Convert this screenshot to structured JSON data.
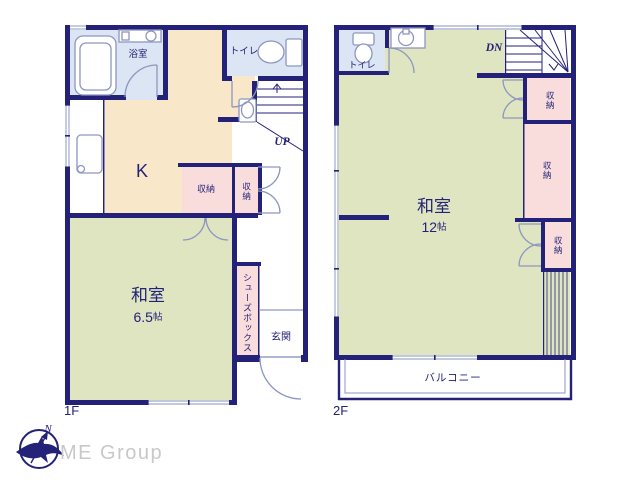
{
  "plan": {
    "floor1": {
      "label": "1F",
      "bathroom": "浴室",
      "toilet": "トイレ",
      "kitchen": "K",
      "storage_a": "収納",
      "storage_b": "収納",
      "tatami_room": "和室",
      "tatami_size_value": "6.5",
      "tatami_size_unit": "帖",
      "shoes_box": "シューズボックス",
      "entrance": "玄関",
      "stairs_up": "UP"
    },
    "floor2": {
      "label": "2F",
      "toilet": "トイレ",
      "stairs_down": "DN",
      "storage_a": "収納",
      "storage_b": "収納",
      "storage_c": "収納",
      "tatami_room": "和室",
      "tatami_size_value": "12",
      "tatami_size_unit": "帖",
      "balcony": "バルコニー"
    },
    "compass_north": "N",
    "company": "ME Group",
    "colors": {
      "wall_navy": "#232278",
      "tatami_green": "#dfe5c1",
      "kitchen_cream": "#f9e7c9",
      "wet_area_blue": "#dbe5f3",
      "closet_pink": "#f9dddd",
      "window_gray": "#aeb6d4",
      "fixture_line": "#8d96c0",
      "logo_gray": "#c8c8c8"
    }
  }
}
